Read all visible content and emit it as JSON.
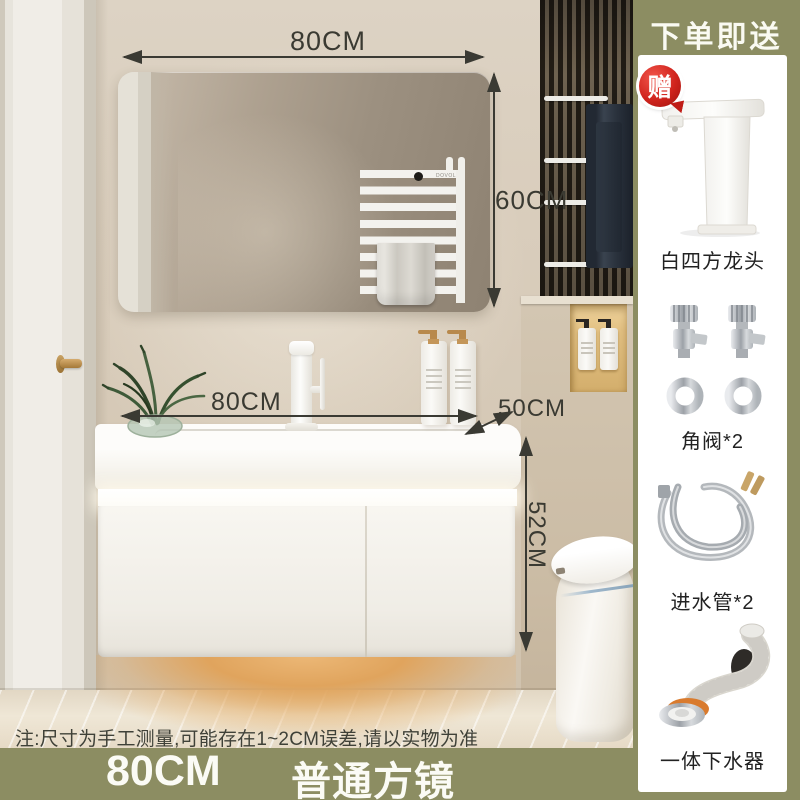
{
  "gift_panel": {
    "title": "下单即送",
    "badge": "赠",
    "items": [
      {
        "name": "white-square-faucet",
        "label": "白四方龙头"
      },
      {
        "name": "angle-valves",
        "label": "角阀*2"
      },
      {
        "name": "inlet-hoses",
        "label": "进水管*2"
      },
      {
        "name": "integrated-drain",
        "label": "一体下水器"
      }
    ]
  },
  "dimensions": {
    "mirror_width": "80CM",
    "mirror_height": "60CM",
    "vanity_width": "80CM",
    "vanity_depth": "50CM",
    "vanity_height": "52CM"
  },
  "note": "注:尺寸为手工测量,可能存在1~2CM误差,请以实物为准",
  "footer": {
    "size_label": "80CM",
    "mirror_label": "普通方镜"
  },
  "scene": {
    "radiator_brand": "DOVOL"
  },
  "colors": {
    "accent_olive": "#8C8D62",
    "badge_red": "#C6201A",
    "arrow": "#3A3A33",
    "wall_beige": "#D9CDBC",
    "glow_amber": "#E0A45D"
  }
}
